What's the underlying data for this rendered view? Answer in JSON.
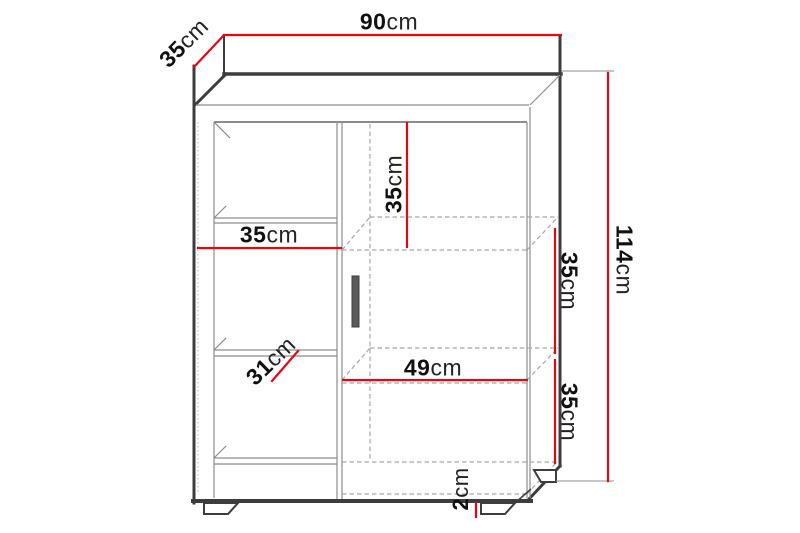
{
  "diagram": {
    "kind": "furniture-dimension-drawing",
    "subject": "cabinet with left open shelves and right door"
  },
  "colors": {
    "dimension_red": "#e30613",
    "outline_dark": "#3d3d3d",
    "line_gray": "#8c8c8c",
    "hidden_gray": "#a6a6a6",
    "dotted_gray": "#bdbdbd",
    "text": "#111111",
    "handle_fill": "#5a5a5a"
  },
  "dimensions": {
    "width_top": {
      "value": "90",
      "unit": "cm"
    },
    "depth_top": {
      "value": "35",
      "unit": "cm"
    },
    "height_right": {
      "value": "114",
      "unit": "cm"
    },
    "left_width": {
      "value": "35",
      "unit": "cm"
    },
    "door_top_height": {
      "value": "35",
      "unit": "cm"
    },
    "right_upper": {
      "value": "35",
      "unit": "cm"
    },
    "right_lower": {
      "value": "35",
      "unit": "cm"
    },
    "inner_width": {
      "value": "49",
      "unit": "cm"
    },
    "left_inner_width": {
      "value": "31",
      "unit": "cm"
    },
    "plinth_height": {
      "value": "2",
      "unit": "cm"
    }
  }
}
